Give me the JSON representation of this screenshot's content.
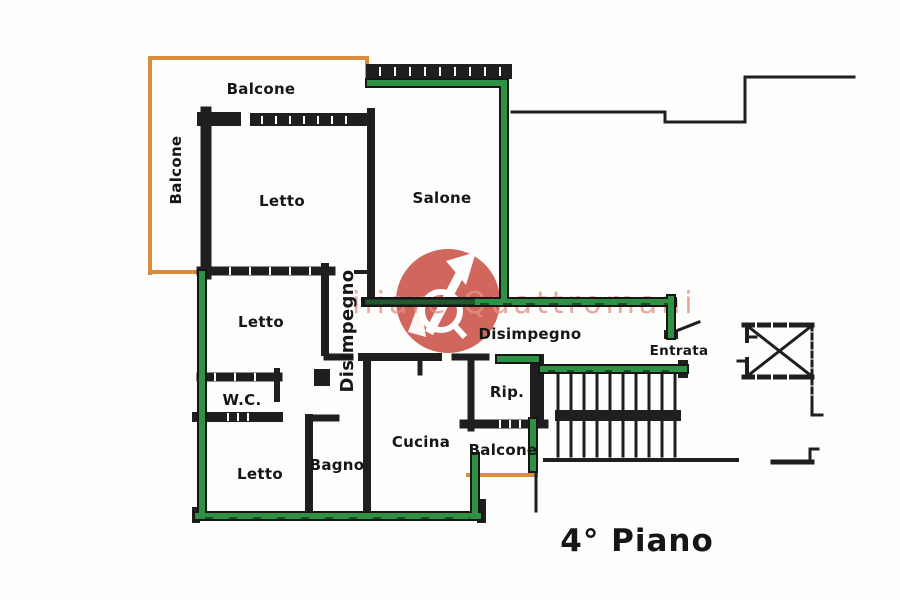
{
  "floor_plan": {
    "labels": {
      "balcone_top": "Balcone",
      "balcone_left": "Balcone",
      "letto_1": "Letto",
      "salone": "Salone",
      "disimpegno_vertical": "Disimpegno",
      "letto_2": "Letto",
      "wc": "W.C.",
      "letto_3": "Letto",
      "bagno": "Bagno",
      "cucina": "Cucina",
      "disimpegno_horizontal": "Disimpegno",
      "rip": "Rip.",
      "balcone_bottom": "Balcone",
      "entrata": "Entrata",
      "floor_label": "4° Piano"
    },
    "watermark": {
      "text": "iliare Quattromani",
      "logo_icon": "arrow-q-circle"
    }
  },
  "colors": {
    "wall": "#1f1f1f",
    "perimeter_green": "#2f9143",
    "balcony_orange": "#d98c3e",
    "watermark_red": "#c7473c",
    "watermark_text_pink": "#e2897b",
    "label": "#161616",
    "background": "#fdfdfb"
  }
}
